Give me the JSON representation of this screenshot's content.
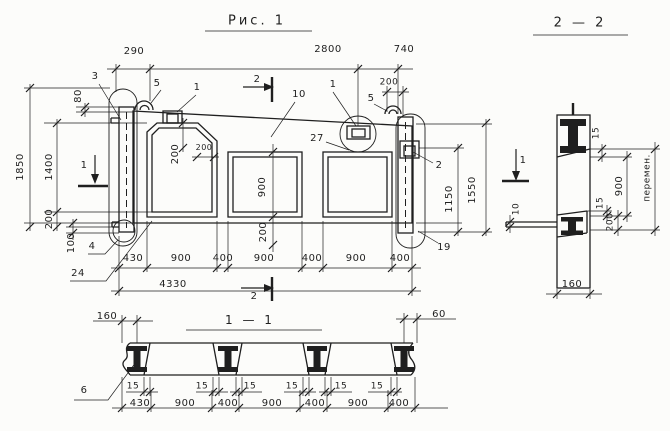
{
  "colors": {
    "ink": "#1f1f1f",
    "paper": "#fcfcfa"
  },
  "titles": {
    "figure": "Рис. 1",
    "section_2_2": "2 — 2",
    "section_1_1": "1 — 1"
  },
  "elevation": {
    "dims_top": {
      "d1": "290",
      "d2": "2800",
      "d3": "740",
      "d4": "200"
    },
    "dims_left": {
      "top": "80",
      "height_total": "1850",
      "height_inner": "1400",
      "bottom": "200",
      "foot": "100"
    },
    "dims_right": {
      "inner": "1150",
      "outer": "1550"
    },
    "dims_opening": {
      "chamfer_v": "200",
      "chamfer_h": "200",
      "mid_height": "900",
      "below": "200"
    },
    "chain": [
      "430",
      "900",
      "400",
      "900",
      "400",
      "900",
      "400"
    ],
    "total": "4330",
    "callouts": {
      "c3": "3",
      "c5_left": "5",
      "c1_left": "1",
      "c10": "10",
      "c1_right": "1",
      "c5_right": "5",
      "c27": "27",
      "c2": "2",
      "c19": "19",
      "c4": "4",
      "c24": "24"
    },
    "marker_1": "1",
    "marker_2": "2"
  },
  "section_1_1": {
    "dim_160": "160",
    "dim_60": "60",
    "dims_15": [
      "15",
      "15",
      "15",
      "15",
      "15",
      "15"
    ],
    "chain": [
      "430",
      "900",
      "400",
      "900",
      "400",
      "900",
      "400"
    ],
    "callout_6": "6"
  },
  "section_2_2": {
    "dim_15_top": "15",
    "dim_900": "900",
    "dim_variable": "перемен.",
    "dim_15_bottom": "15",
    "dim_200": "200",
    "dim_10": "10",
    "dim_160": "160",
    "marker_1": "1"
  }
}
